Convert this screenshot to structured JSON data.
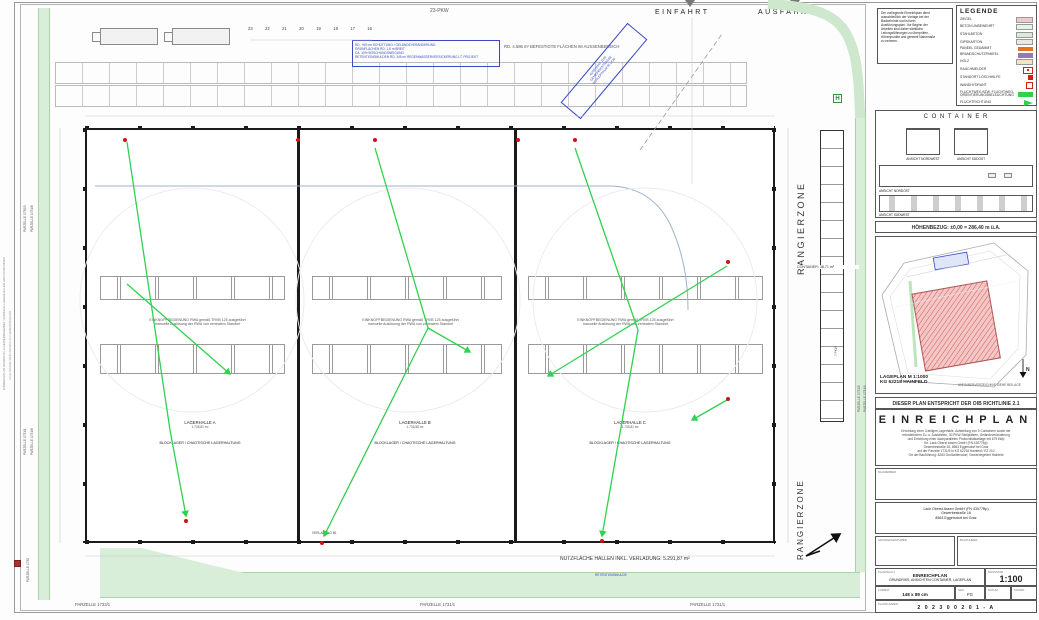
{
  "sheet": {
    "edge_note_1": "EINREICHPLAN 2023002.01-A  GEWERBEGEBIET HAINFELD  LAGERHALLEN UND CONTAINER",
    "edge_note_2": "ALLE MASSE SIND AM BAU ZU UEBERPRUEFEN"
  },
  "drawing": {
    "einfahrt": "EINFAHRT",
    "ausfahrt": "AUSFAHRT",
    "pkw_label": "23-PKW",
    "stall_numbers": [
      "23",
      "22",
      "21",
      "20",
      "19",
      "18",
      "17",
      "16"
    ],
    "site_note_lines": [
      "RD. +65 cm SCHÜTTUNG / GELÄNDEVERÄNDERUNG",
      "GRÜNFLÄCHEN RD. 1,8 m BREIT",
      "CA. 10% BÖSCHUNGSNEIGUNG",
      "RETENTIONSMULDEN RD. 345 m³ REGENWASSERVERSICKERUNG LT. PROJEKT"
    ],
    "befestigte_note": "RD. 4.586 m² BEFESTIGTE FLÄCHEN IM AUSSENBEREICH",
    "ausfahrt_note_lines": [
      "AUSFAHRT ZUR",
      "GEMEINDESTRASSE",
      "SCHLEPPKURVE LKW"
    ],
    "rangierzone": "RANGIERZONE",
    "container_area_label": "CONTAINER: 38,71 m²",
    "pkw7_label": "7 PKW",
    "hydrant_symbol": "H",
    "rwa_note_line1": "EINKNOPFBEDIENUNG RWA gemäß TRVB 125 ausgeführt",
    "rwa_note_line2": "manuelle Auslösung der RWA von zentralem Standort",
    "halls": [
      {
        "name": "LAGERHALLE A",
        "area": "1.745,81 m²",
        "usage": "BLOCKLAGER / CHAOTISCHE LAGERHALTUNG"
      },
      {
        "name": "LAGERHALLE B",
        "area": "1.736,58 m²",
        "usage": "BLOCKLAGER / CHAOTISCHE LAGERHALTUNG"
      },
      {
        "name": "LAGERHALLE C",
        "area": "1.745,81 m²",
        "usage": "BLOCKLAGER / CHAOTISCHE LAGERHALTUNG"
      }
    ],
    "verladung_label": "VERLADUNG B1",
    "retention_label": "RETENTIONSMULDE",
    "nutzflaeche": "NUTZFLÄCHE HALLEN INKL. VERLADUNG: 5.291,87 m²",
    "parcels": {
      "left_top_1": "PARZELLE 1730/3",
      "left_top_2": "PARZELLE 1731/8",
      "left_bottom_1": "PARZELLE 1731/1",
      "left_bottom_2": "PARZELLE 1731/8",
      "left_corner": "PARZELLE 1730",
      "right_1": "PARZELLE 1731/5",
      "right_2": "PARZELLE 1731/9",
      "bottom_left": "PARZELLE 1733/1",
      "bottom_center": "PARZELLE 1731/1",
      "bottom_right": "PARZELLE 1731/1"
    }
  },
  "side_note": {
    "lines": [
      "Der vorliegende Einreichplan dient",
      "ausschließlich der Vorlage bei der",
      "Baubehörde und ist kein",
      "Ausführungsplan. Vor Beginn der",
      "Arbeiten sind daher sämtliche",
      "Leitungsführungen zu überprüfen,",
      "Höhenpunkte und generell Naturmaße",
      "zu nehmen."
    ]
  },
  "legend": {
    "title": "LEGENDE",
    "items": [
      {
        "label": "ZIEGEL",
        "color": "#efc8c8"
      },
      {
        "label": "BETON UNBEWEHRT",
        "color": "#e8f2e8"
      },
      {
        "label": "STAHLBETON",
        "color": "#d8ead8"
      },
      {
        "label": "GIPSKARTON",
        "color": "#e8e8e8"
      },
      {
        "label": "PANEEL GEDÄMMT",
        "color": "#e2761e"
      },
      {
        "label": "BRANDSCHUTZPANEEL",
        "color": "#937ab0"
      },
      {
        "label": "HOLZ",
        "color": "#efe3c8"
      },
      {
        "label": "RAUCHMELDER",
        "color": "#cc2211"
      },
      {
        "label": "STANDORT LÖSCHHILFE",
        "color": "#cc2211"
      },
      {
        "label": "WANDHYDRANT",
        "color": "#cc2211"
      },
      {
        "label": "FLUCHTWEG BZW. FLUCHTWEG-ORIENTIERUNGSBELEUCHTUNG",
        "color": "#2fd24f"
      },
      {
        "label": "FLUCHTRICHTUNG",
        "color": "#2fd24f"
      }
    ]
  },
  "container_views": {
    "title": "C O N T A I N E R",
    "labels": [
      "ANSICHT NORDWEST",
      "ANSICHT SÜDOST",
      "ANSICHT NORDOST",
      "ANSICHT SÜDWEST"
    ]
  },
  "hoehenbezug": "HÖHENBEZUG: ±0,00 = 286,40 m ü.A.",
  "lageplan": {
    "line1": "LAGEPLAN  M 1:1000",
    "line2": "KG 62218 HAINFELD",
    "side_note": "ANRAINERVERZEICHNIS SIEHE BEILAGE",
    "north": "N"
  },
  "oib_line": "DIESER PLAN ENTSPRICHT DER OIB RICHTLINIE 2.1",
  "einreichplan": {
    "title": "EINREICHPLAN",
    "description_lines": [
      "Errichtung einer 3-teiligen Lagerhalle, Aufstellung von 3 Containern sowie der",
      "erforderlichen Zu- u. Ausfahrten, 30 PKW-Stellplätzen, Geländeveränderung",
      "und Errichtung einer dachparallelen Photovoltaikanlage mit 679 kWp",
      "für: Lack Oberst Assen GmbH (FN 43077Bp)",
      "Gewerbestraße 16, 8563 Eggersdorf bei Graz",
      "auf der Parzelle 1731/5 in KG 62218 Hainfeld / EZ 210",
      "Ort der Bauführung: 8283 Großwilfersdorf, Gewerbegebiet Hainfeld"
    ],
    "box1_label": "BAUWERBER",
    "address_lines": [
      "Lack Oberst Assen GmbH (FN 43077Bp)",
      "Gewerbestraße 16",
      "8563 Eggersdorf bei Graz"
    ],
    "box2_label": "GRUNDEIGENTÜMER",
    "box3_label": "BAUFÜHRER"
  },
  "title_block": {
    "content_label": "PLANINHALT",
    "plan_type": "EINREICHPLAN",
    "content": "GRUNDRISS, ANSICHTEN CONTAINER, LAGEPLAN",
    "scale_label": "MASSSTAB",
    "scale": "1:100",
    "format_label": "FORMAT",
    "format": "148 x 89 cm",
    "drawn_label": "GEZ.",
    "drawn": "FG",
    "date_label": "DATUM",
    "coord_label": "KOORD.",
    "number_label": "PLANNUMMER",
    "number": "2 0 2 3 0 0 2 0 1 - A"
  }
}
